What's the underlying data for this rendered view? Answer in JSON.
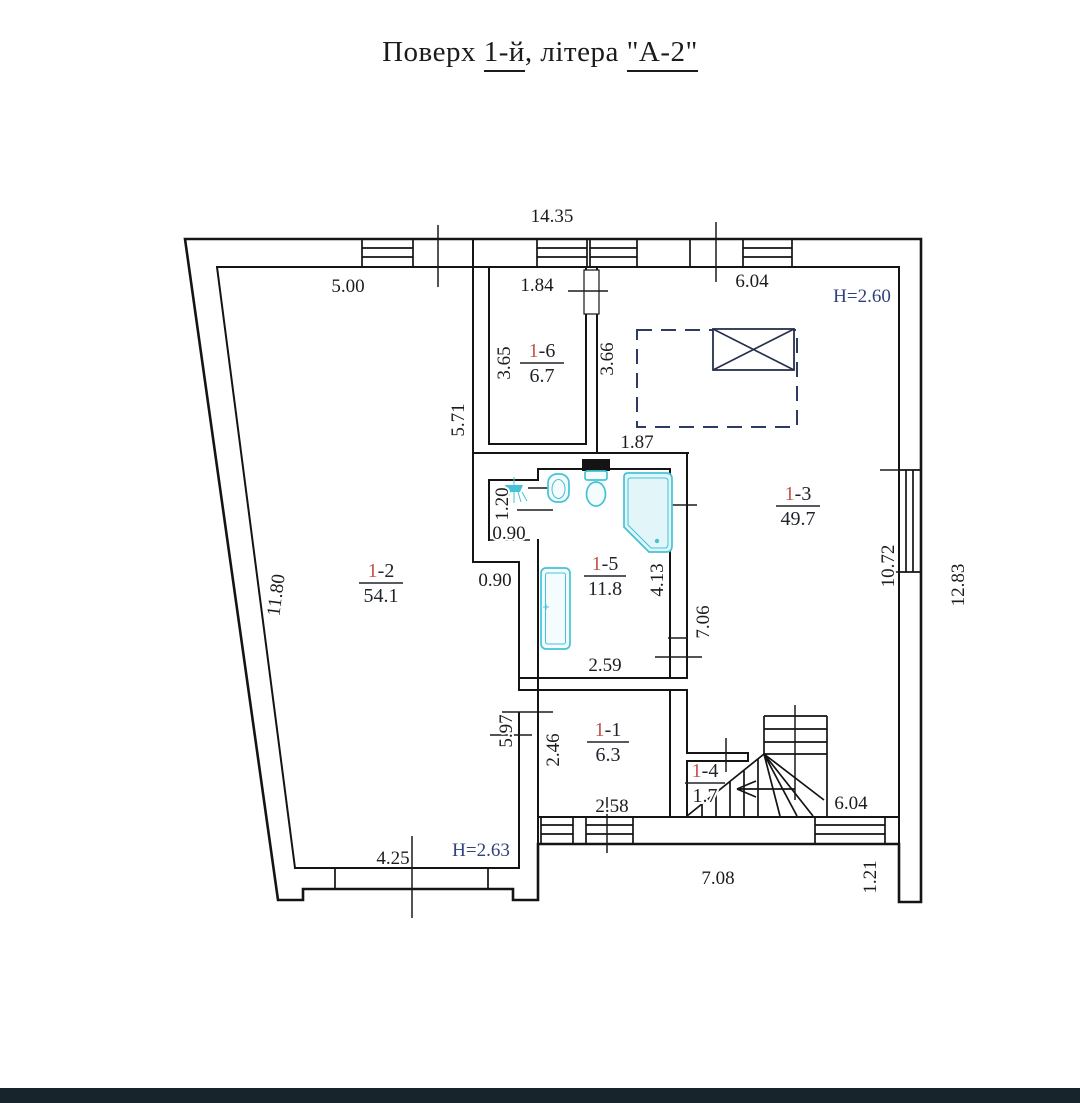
{
  "title": {
    "part1": "Поверх ",
    "floor": "1-й",
    "part2": ", літера ",
    "letter": "\"А-2\""
  },
  "rooms": {
    "r11": {
      "prefix": "1",
      "suffix": "-1",
      "area": "6.3"
    },
    "r12": {
      "prefix": "1",
      "suffix": "-2",
      "area": "54.1"
    },
    "r13": {
      "prefix": "1",
      "suffix": "-3",
      "area": "49.7"
    },
    "r14": {
      "prefix": "1",
      "suffix": "-4",
      "area": "1.7"
    },
    "r15": {
      "prefix": "1",
      "suffix": "-5",
      "area": "11.8"
    },
    "r16": {
      "prefix": "1",
      "suffix": "-6",
      "area": "6.7"
    }
  },
  "dims": {
    "top_total": "14.35",
    "seg_5_00": "5.00",
    "seg_1_84": "1.84",
    "seg_6_04_top": "6.04",
    "v_3_65": "3.65",
    "v_3_66": "3.66",
    "seg_1_87": "1.87",
    "v_5_71": "5.71",
    "v_11_80": "11.80",
    "v_1_20": "1.20",
    "seg_0_90_niche": "0.90",
    "seg_0_90_room": "0.90",
    "v_4_13": "4.13",
    "v_7_06": "7.06",
    "seg_2_59": "2.59",
    "v_5_97": "5.97",
    "v_2_46": "2.46",
    "seg_2_58": "2.58",
    "seg_6_04_bottom": "6.04",
    "seg_4_25": "4.25",
    "seg_7_08": "7.08",
    "v_1_21": "1.21",
    "v_10_72": "10.72",
    "v_12_83": "12.83"
  },
  "heights": {
    "right": "H=2.60",
    "left": "H=2.63"
  },
  "colors": {
    "walls": "#141414",
    "text": "#1b1b1b",
    "height_label": "#31417b",
    "room_number_accent": "#c2544c",
    "fixtures": "#44c3d6",
    "dashed_opening": "#2d3a63",
    "footer_bar": "#17242b",
    "background": "#ffffff"
  },
  "icons": {
    "shower": "shower-icon",
    "bathtub": "bathtub-icon",
    "toilet": "toilet-icon",
    "bidet": "bidet-icon",
    "corner_bath": "corner-bath-icon",
    "stairs_arrow": "stairs-direction-arrow"
  }
}
